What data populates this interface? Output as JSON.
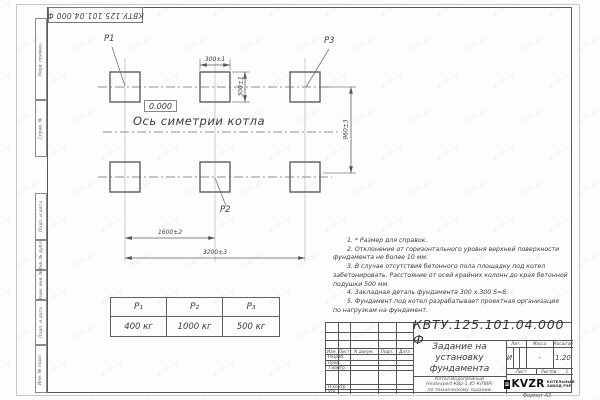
{
  "watermark": "KVZR.RU",
  "stamp_top": "КВТУ.125.101.04.000 Ф",
  "side_labels": [
    "Перв. примен.",
    "Справ. №",
    "Подп. и дата",
    "Инв. № дубл.",
    "Взам. инв. №",
    "Подп. и дата",
    "Инв. № подл."
  ],
  "drawing": {
    "labels": {
      "p1": "P1",
      "p2": "P2",
      "p3": "P3"
    },
    "elevation": "0.000",
    "axis_text": "Ось симетрии котла",
    "dims": {
      "pad_width": "300±1",
      "pad_height": "300±1",
      "row_spacing": "960±3",
      "col_spacing": "1600±2",
      "overall": "3200±3"
    }
  },
  "load_table": {
    "headers": [
      "P₁",
      "P₂",
      "P₃"
    ],
    "values": [
      "400 кг",
      "1000 кг",
      "500 кг"
    ]
  },
  "notes": [
    "1. * Размер для справок.",
    "2. Отклонение от горизонтального уровня верхней поверхности",
    "фундамента не более 10 мм.",
    "3. В случае отсутствия бетонного пола площадку под котел",
    "забетонировать. Расстояние от осей крайних колонн до края бетонной",
    "подушки 500 мм.",
    "4. Закладная деталь фундамента 300 x 300 S=8.",
    "5. Фундамент под котел разрабатывает проектная организация",
    "по нагрузкам на фундамент."
  ],
  "title_block": {
    "doc_number": "КВТУ.125.101.04.000 Ф",
    "title_lines": [
      "Задание на",
      "установку",
      "фундамента"
    ],
    "subtitle_lines": [
      "Котел Водогрейный",
      "Heatexpert-КВр-1,45-К(ПВР)",
      "по техническому заданию"
    ],
    "col_headers": {
      "izm": "Изм.",
      "list": "Лист",
      "doc": "N докум.",
      "podp": "Подп.",
      "data": "Дата"
    },
    "row_labels": [
      "Разраб.",
      "Пров.",
      "Т.контр.",
      "Н.контр.",
      "Утв."
    ],
    "lit_header": "Лит.",
    "mass_header": "Масса",
    "scale_header": "Масштаб",
    "lit_value": "И",
    "mass_value": "-",
    "scale_value": "1:20",
    "sheet_label": "Лист",
    "sheets_label": "Листов",
    "sheets_value": "1",
    "logo_text": "KVZR",
    "logo_caption_lines": [
      "КОТЕЛЬНЫЙ",
      "ЗАВОД РЭП"
    ],
    "format_note": "Формат А3"
  }
}
